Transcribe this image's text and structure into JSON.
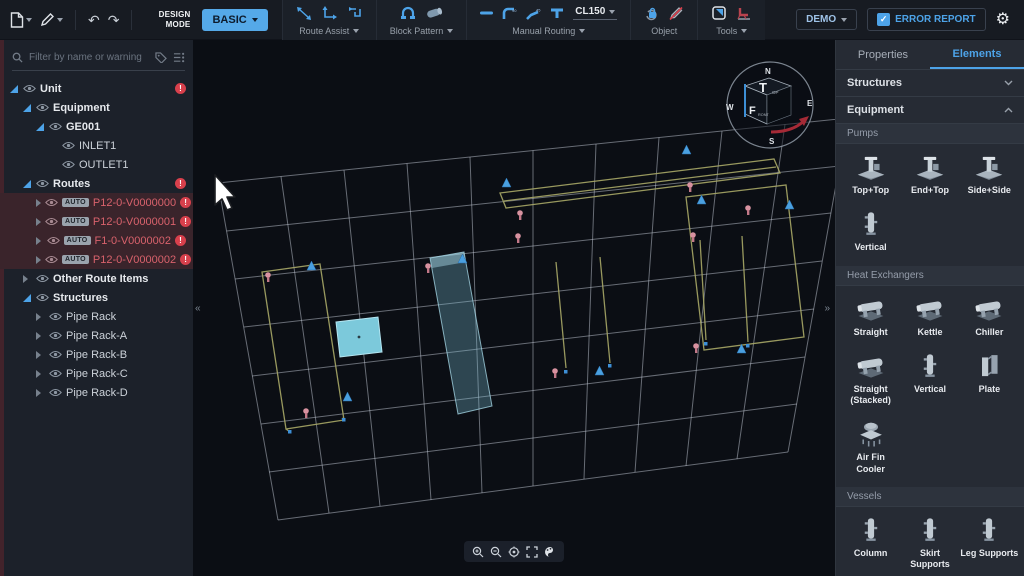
{
  "toolbar": {
    "design_mode_label": "DESIGN MODE",
    "mode_button_label": "BASIC",
    "route_assist_label": "Route Assist",
    "block_pattern_label": "Block Pattern",
    "manual_routing_label": "Manual Routing",
    "spec_value": "CL150",
    "object_label": "Object",
    "tools_label": "Tools",
    "demo_button_label": "DEMO",
    "error_report_label": "ERROR REPORT"
  },
  "icons": {
    "undo": "↶",
    "redo": "↷",
    "gear": "⚙",
    "check": "✓",
    "warning": "!",
    "collapse_left": "«",
    "collapse_right": "»"
  },
  "sidebar": {
    "filter_placeholder": "Filter by name or warning",
    "auto_badge": "AUTO",
    "tree": [
      {
        "label": "Unit",
        "error": true
      },
      {
        "label": "Equipment"
      },
      {
        "label": "GE001"
      },
      {
        "label": "INLET1"
      },
      {
        "label": "OUTLET1"
      },
      {
        "label": "Routes",
        "error": true
      },
      {
        "label": "P12-0-V0000000",
        "auto": true,
        "selected": true,
        "error": true
      },
      {
        "label": "P12-0-V0000001",
        "auto": true,
        "selected": true,
        "error": true
      },
      {
        "label": "F1-0-V0000002",
        "auto": true,
        "selected": true,
        "error": true
      },
      {
        "label": "P12-0-V0000002",
        "auto": true,
        "selected": true,
        "error": true
      },
      {
        "label": "Other Route Items"
      },
      {
        "label": "Structures"
      },
      {
        "label": "Pipe Rack"
      },
      {
        "label": "Pipe Rack-A"
      },
      {
        "label": "Pipe Rack-B"
      },
      {
        "label": "Pipe Rack-C"
      },
      {
        "label": "Pipe Rack-D"
      }
    ]
  },
  "viewport": {
    "compass": {
      "n": "N",
      "e": "E",
      "s": "S",
      "w": "W",
      "cube_top": "T",
      "cube_top_sub": "OP",
      "cube_front": "F",
      "cube_front_sub": "RONT"
    }
  },
  "panel": {
    "tab_properties": "Properties",
    "tab_elements": "Elements",
    "section_structures": "Structures",
    "section_equipment": "Equipment",
    "groups": {
      "pumps": {
        "label": "Pumps",
        "items": [
          "Top+Top",
          "End+Top",
          "Side+Side",
          "Vertical"
        ]
      },
      "heat_exchangers": {
        "label": "Heat Exchangers",
        "items": [
          "Straight",
          "Kettle",
          "Chiller",
          "Straight (Stacked)",
          "Vertical",
          "Plate",
          "Air Fin Cooler"
        ]
      },
      "vessels": {
        "label": "Vessels",
        "items": [
          "Column",
          "Skirt Supports",
          "Leg Supports"
        ]
      }
    }
  }
}
